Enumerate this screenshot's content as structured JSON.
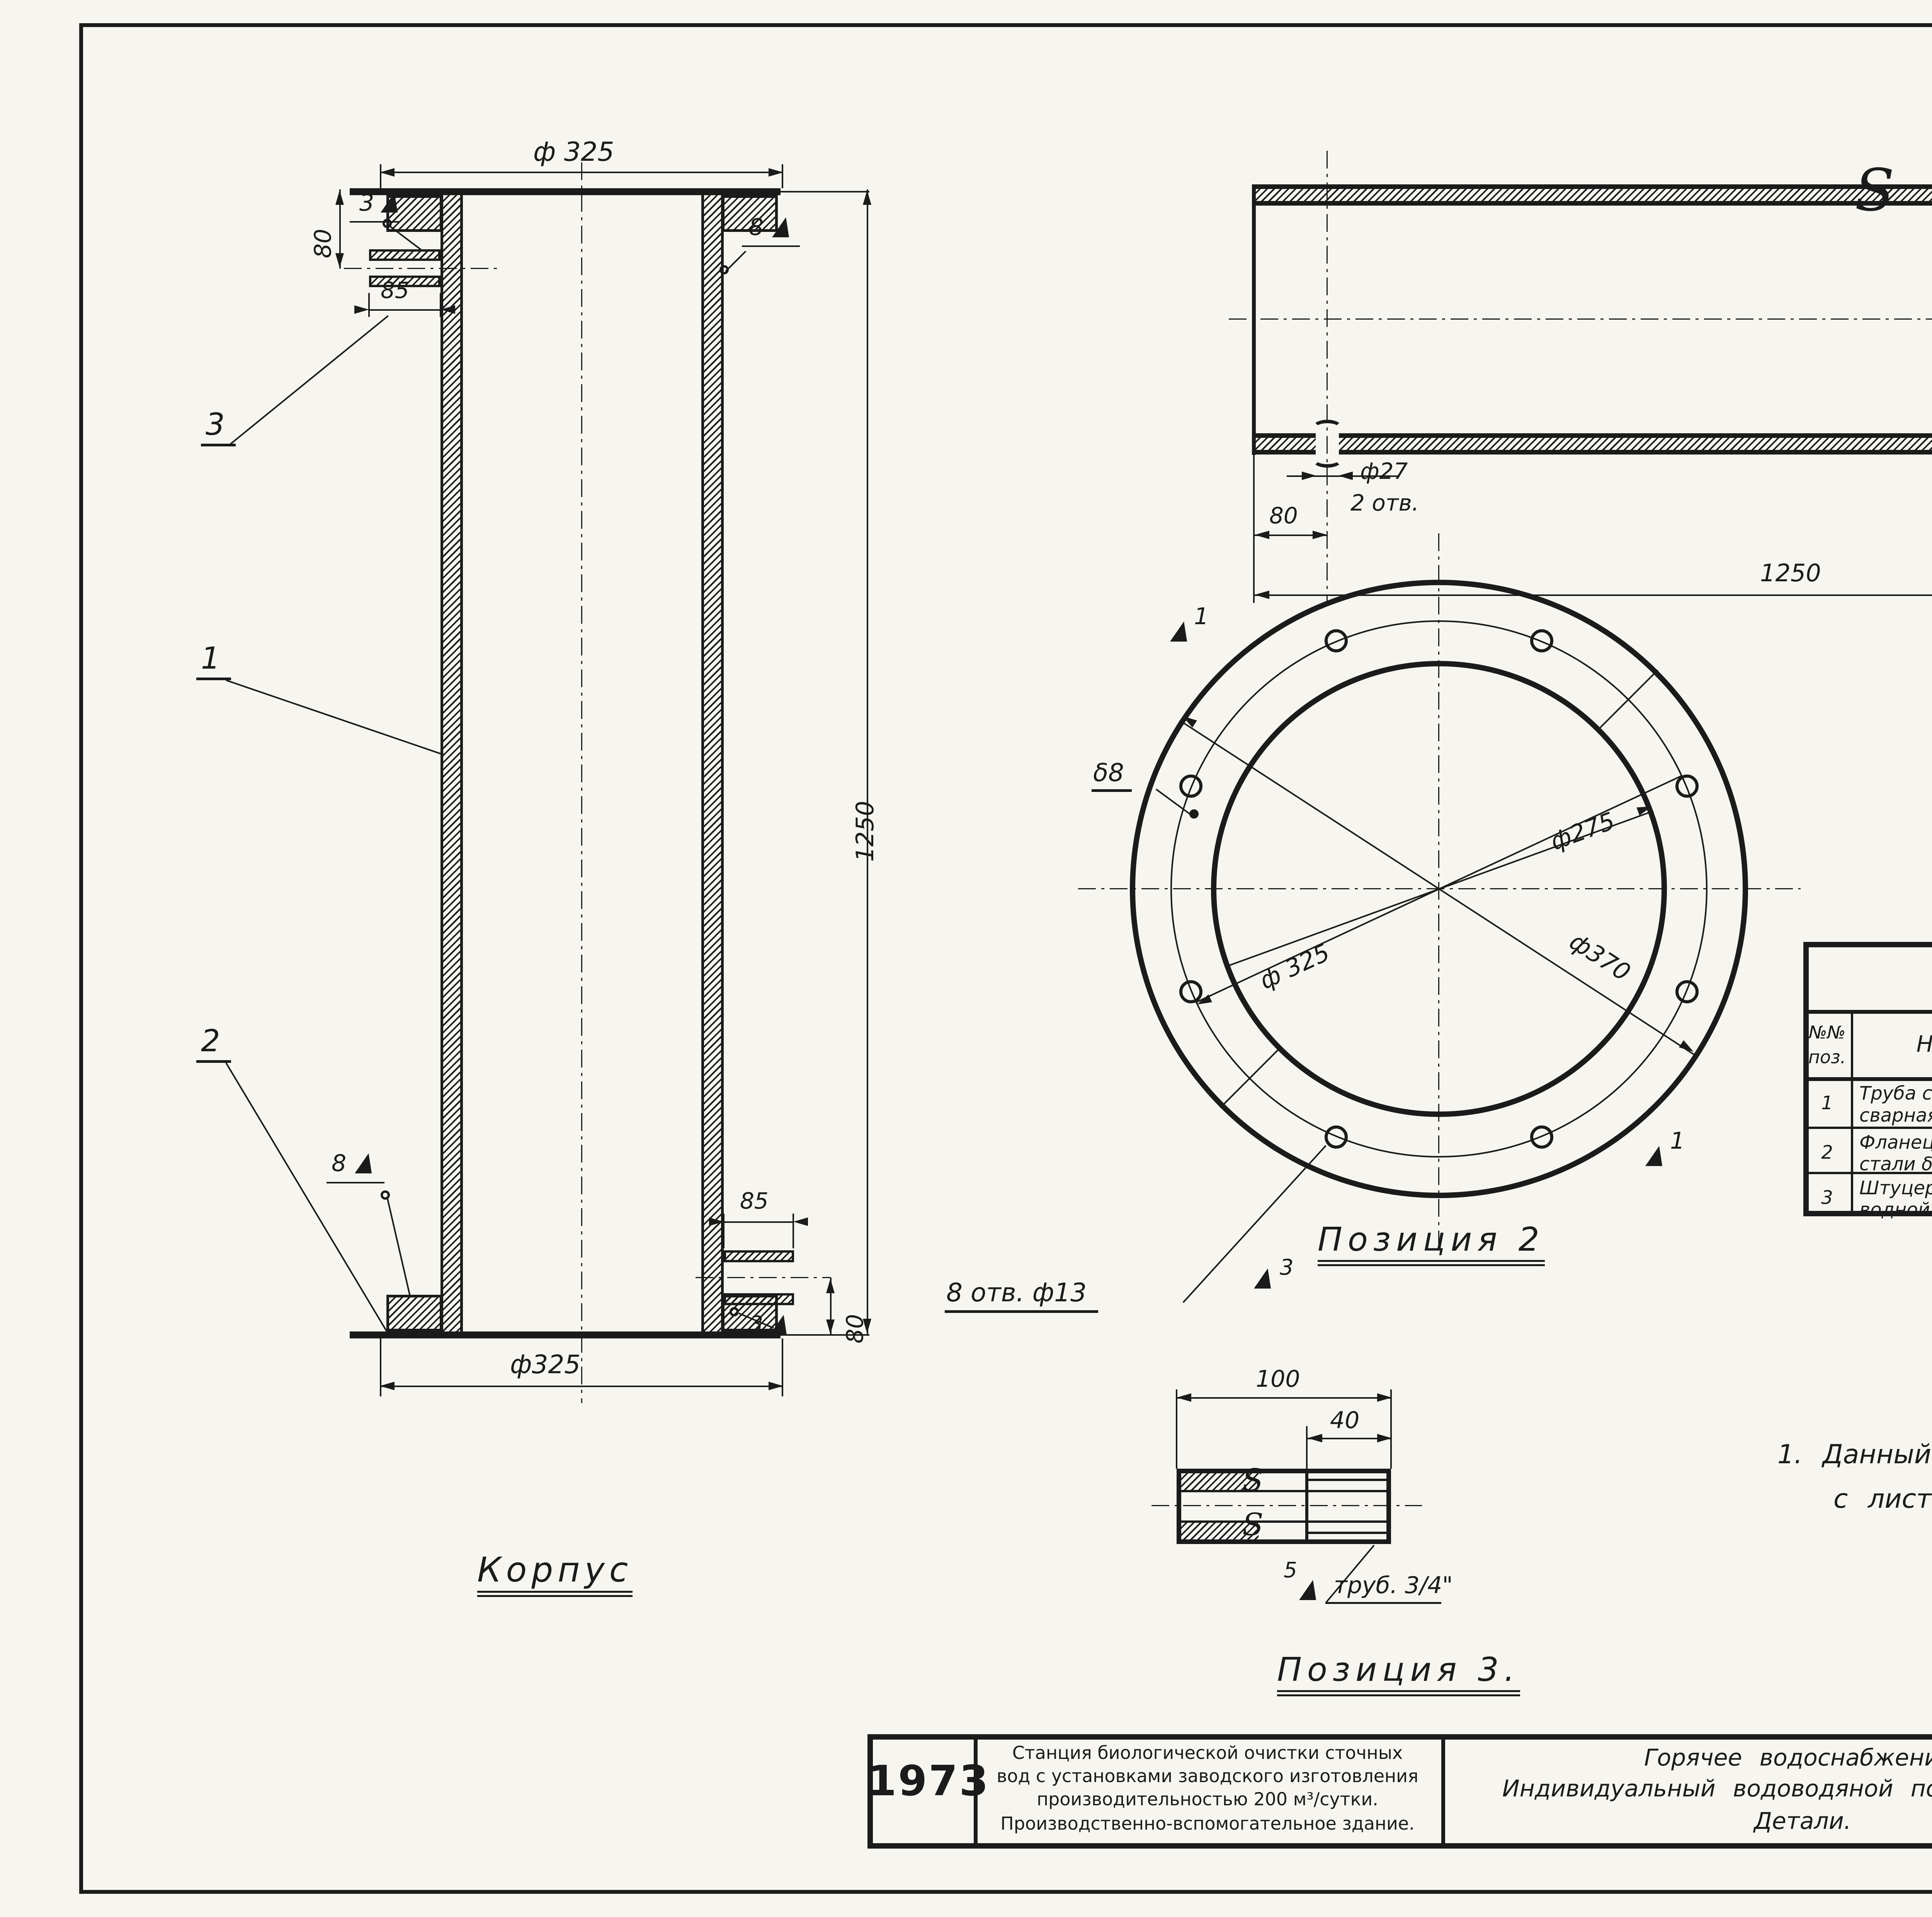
{
  "sheet": {
    "corner_number": "35",
    "doc_code": "13247-П1",
    "doc_code2": "20"
  },
  "korpus": {
    "title": "Корпус",
    "dim_top_dia": "ф 325",
    "dim_bottom_dia": "ф325",
    "dim_height": "1250",
    "dim_top_offset": "80",
    "dim_stub_top_len": "85",
    "dim_stub_bot_len": "85",
    "dim_bot_offset": "80",
    "callout_1": "1",
    "callout_2": "2",
    "callout_3": "3",
    "weld_top": "3",
    "weld_right": "8",
    "weld_bottom_left": "8",
    "weld_bottom_right": "3"
  },
  "pipe": {
    "dim_hole_dia": "ф27",
    "dim_hole_count": "2 отв.",
    "dim_left": "80",
    "dim_right": "80",
    "dim_length": "1250"
  },
  "flange": {
    "title": "Позиция 2",
    "dim_bore": "ф275",
    "dim_bolt": "ф 325",
    "dim_outer": "ф370",
    "thickness": "δ8",
    "holes": "8 отв. ф13",
    "mark_top": "1",
    "mark_bottom": "1",
    "mark_holes": "3"
  },
  "fitting": {
    "title": "Позиция 3.",
    "dim_length": "100",
    "dim_thread": "40",
    "thread": "труб. 3/4\"",
    "weld": "5"
  },
  "spec": {
    "title": "Спецификация",
    "h_pos1": "№№",
    "h_pos2": "поз.",
    "h_name": "Наименование",
    "h_size1": "Основн.",
    "h_size2": "размер",
    "h_unit1": "Ед.",
    "h_unit2": "изм.",
    "h_qty": "Кол.",
    "h_weight": "Вес в кг",
    "h_wu": "Един.",
    "h_wt": "Общ.",
    "h_note1": "Приме-",
    "h_note2": "чание",
    "rows": [
      {
        "pos": "1",
        "name1": "Труба стальная электро-",
        "name2": "сварная.",
        "size1": "d=273×8",
        "size2": "ℓ=1250мм",
        "unit": "шт",
        "qty": "1",
        "wu": "65,3",
        "wt": "65,3",
        "gost1": "ГОСТ",
        "gost2": "10704-63"
      },
      {
        "pos": "2",
        "name1": "Фланец из листовой",
        "name2": "стали δ= 8мм",
        "size1": "ф370/",
        "size2": "ф275",
        "unit": "″",
        "qty": "2",
        "wu": "3,0",
        "wt": "6,0",
        "gost1": "ГОСТ",
        "gost2": "5681-57"
      },
      {
        "pos": "3",
        "name1": "Штуцер из водогазопро-",
        "name2": "водной трубы",
        "size1": "d=20",
        "size2": "ℓ=100мм",
        "unit": "″",
        "qty": "2",
        "wu": "0,16",
        "wt": "0,32",
        "gost1": "ГОСТ",
        "gost2": "3262-62."
      }
    ]
  },
  "notes": {
    "title": "Примечание",
    "line1": "1.   Данный   лист   рассматривать   совместно",
    "line2": "с  листом  ОВ-6"
  },
  "titleblock": {
    "year": "1973",
    "facility1": "Станция биологической очистки сточных",
    "facility2": "вод с установками заводского изготовления",
    "facility3": "производительностью 200 м³/сутки.",
    "facility4": "Производственно-вспомогательное здание.",
    "subject1": "Горячее   водоснабжение.",
    "subject2": "Индивидуальный   водоводяной   подогреватель.",
    "subject3": "Детали.",
    "project_label": "Типовой проект",
    "project_number": "902-2-224",
    "album_label": "Альбом",
    "album_number": "I",
    "sheet_label": "Лист",
    "sheet_number": "ОВ-7"
  }
}
